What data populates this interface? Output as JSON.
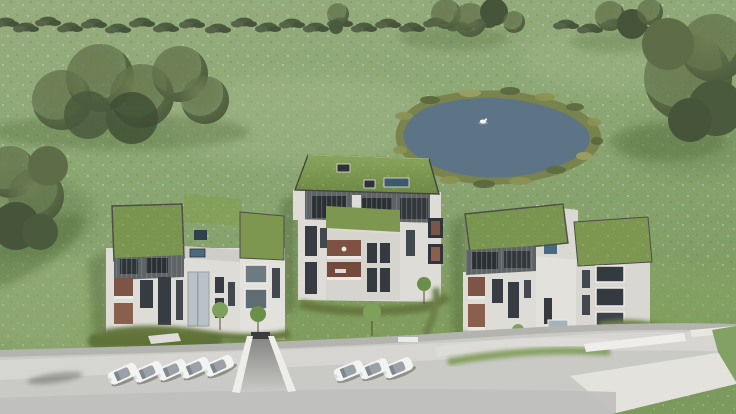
{
  "scene": {
    "type": "3d-architectural-aerial-rendering",
    "description": "Bird's-eye render of a residential development: three modern apartment blocks with sedum green roofs in a flowered meadow, a natural pond with a swan behind them, a dense tree line along the top, and a curved light concrete access road with white parked cars along the bottom.",
    "counts": {
      "buildings": 3,
      "parked_cars": 8,
      "cars_left_row": 5,
      "cars_right_row": 3,
      "ponds": 1,
      "swans": 1
    },
    "buildings": {
      "left": {
        "label": "west block",
        "storeys_visible": 3,
        "roof": "flat sedum green roofs",
        "attic": "dark grey slatted cladding",
        "facade": "white render with dark window slots and timber loggias"
      },
      "middle": {
        "label": "centre block",
        "storeys_visible": 4,
        "roof": "pitched sedum green roof with three skylights",
        "attic": "dark grey slatted cladding band",
        "facade": "white render with recessed timber terraces"
      },
      "right": {
        "label": "east block",
        "storeys_visible": 3,
        "roof": "flat sedum green roofs on two volumes",
        "attic": "dark grey slatted cladding",
        "facade": "white render with stacked picture windows"
      }
    },
    "landscape": {
      "pond": {
        "shape": "irregular oval",
        "edge": "reed and tall-grass fringe",
        "wildlife": "one white swan"
      },
      "meadow": "light green meadow speckled with white wildflowers",
      "tree_line": "dense shrub and tree belt along the top edge and left side",
      "hedges": "curved clipped hedges and saplings around each building",
      "road": "curved light concrete access road with roadside parking",
      "garage_ramp": "white-walled ramp to the underground garage between west and centre blocks"
    },
    "colors": {
      "meadow_light": "#9aaf80",
      "meadow_dark": "#7e9a60",
      "lawn": "#7f9d58",
      "tree_dark": "#4b5b3e",
      "hedge": "#66783f",
      "pond_water": "#5d7486",
      "reed_fringe": "#79834e",
      "roof_green": "#7a954f",
      "facade_white": "#dedcd7",
      "cladding_grey": "#5e6365",
      "window_dark": "#363c41",
      "timber_terrace": "#7e5242",
      "road_grey": "#c9c9c6",
      "pavement_light": "#d8d7d3",
      "wall_white": "#efede9",
      "car_body": "#f3f3f1"
    }
  }
}
